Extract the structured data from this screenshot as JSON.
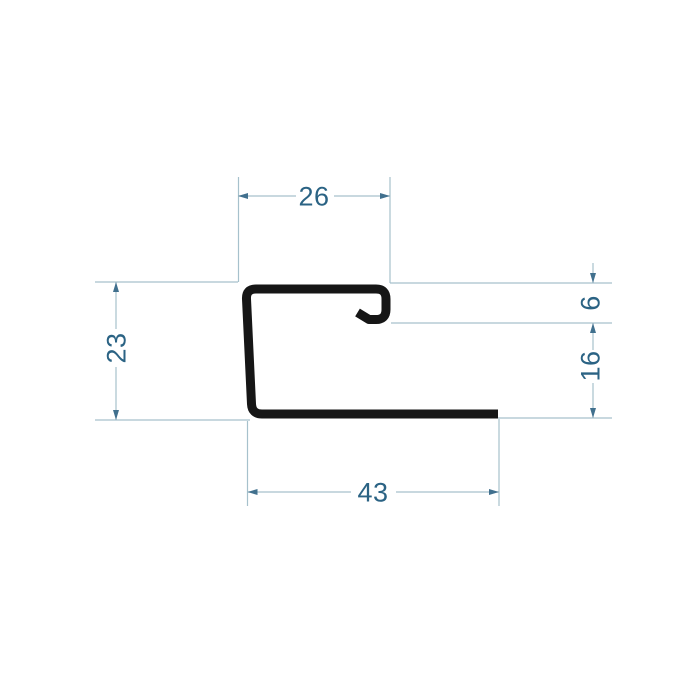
{
  "drawing": {
    "title": "profile-cross-section-technical-drawing",
    "profile_type": "J-trim channel profile",
    "units_shown": "none (plain numbers)",
    "dimensions": {
      "top_width": "26",
      "lip_depth": "6",
      "right_height": "16",
      "left_height": "23",
      "bottom_width": "43"
    },
    "colors": {
      "background": "#ffffff",
      "profile": "#161616",
      "dimension_line": "#a6c1cc",
      "arrow": "#41708e",
      "text": "#2b6384"
    }
  }
}
